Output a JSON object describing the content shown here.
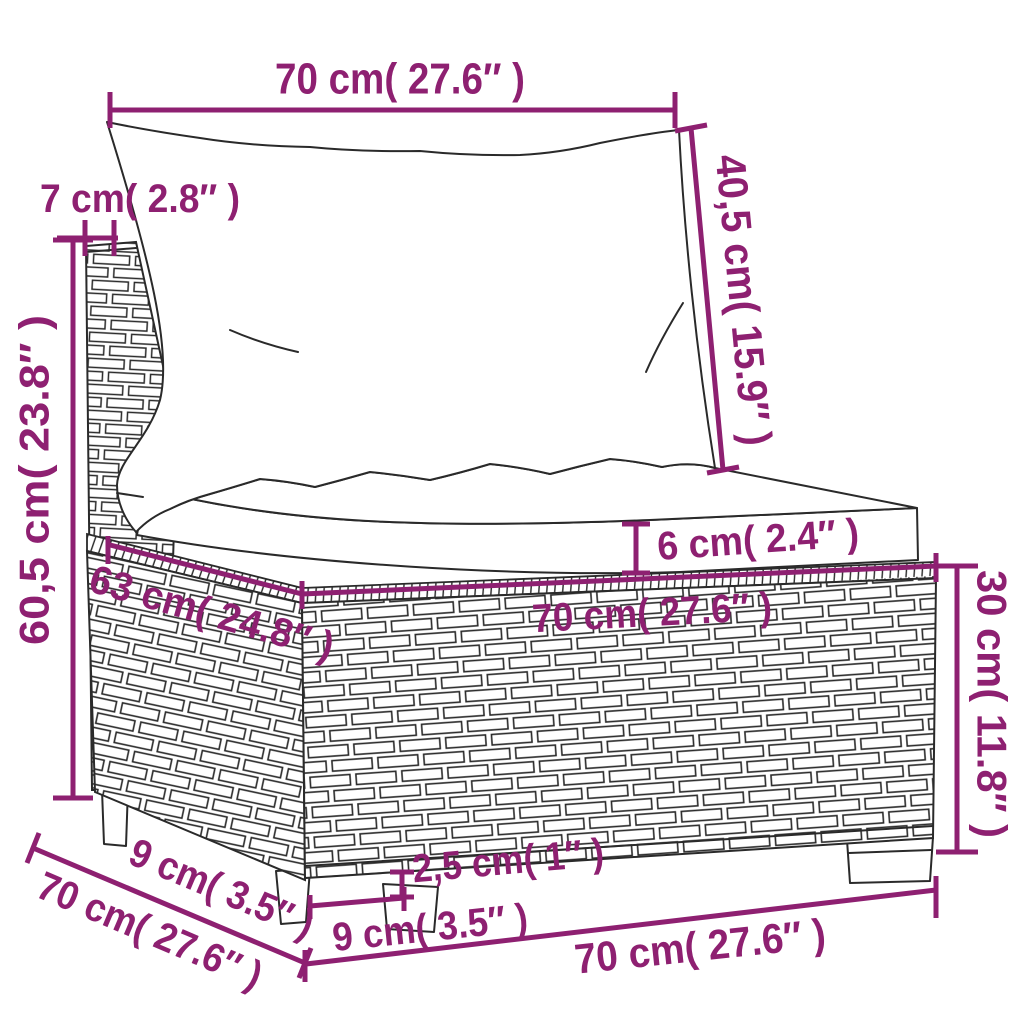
{
  "colors": {
    "accent": "#8e2071",
    "line_art": "#2a2a2a",
    "background": "#ffffff"
  },
  "labels": {
    "top_width": "70 cm( 27.6″ )",
    "back_thickness": "7 cm( 2.8″ )",
    "back_cushion_height": "40,5 cm( 15.9″ )",
    "total_height": "60,5 cm( 23.8″ )",
    "seat_depth": "63 cm( 24.8″ )",
    "cushion_thickness": "6 cm( 2.4″ )",
    "seat_width": "70 cm( 27.6″ )",
    "base_height": "30 cm( 11.8″ )",
    "foot_height": "2,5 cm( 1″ )",
    "foot_width": "9 cm( 3.5″ )",
    "side_foot_inset": "9 cm( 3.5″ )",
    "base_depth": "70 cm( 27.6″ )",
    "base_width_bottom": "70 cm( 27.6″ )"
  }
}
